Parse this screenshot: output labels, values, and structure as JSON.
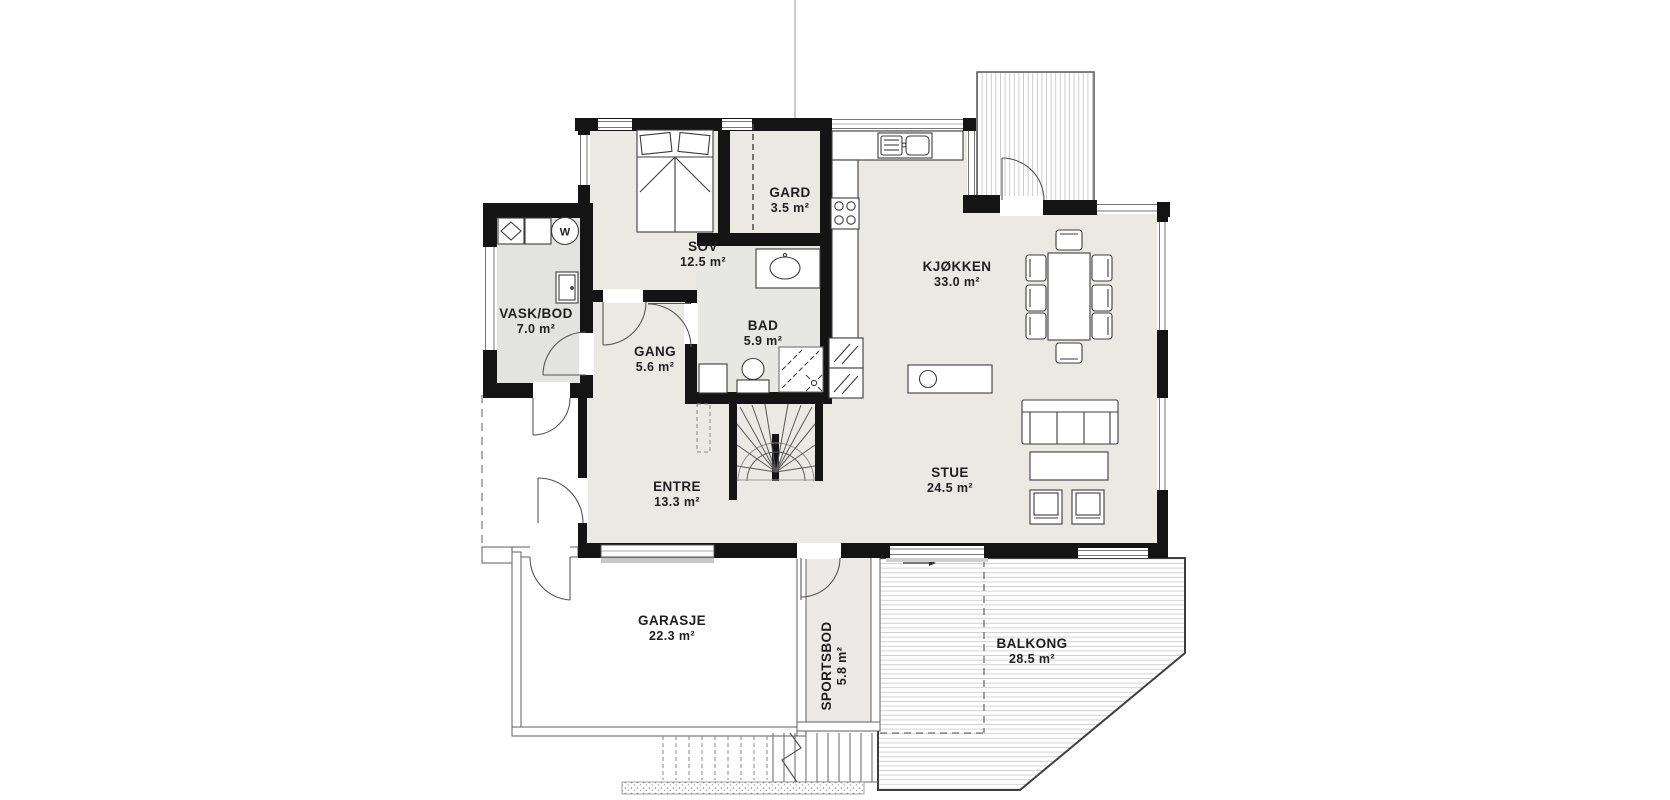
{
  "plan_title": "First floor plan",
  "rooms": [
    {
      "id": "sov",
      "name": "SOV",
      "area": "12.5 m²"
    },
    {
      "id": "gard",
      "name": "GARD",
      "area": "3.5 m²"
    },
    {
      "id": "kjokken",
      "name": "KJØKKEN",
      "area": "33.0 m²"
    },
    {
      "id": "vask_bod",
      "name": "VASK/BOD",
      "area": "7.0 m²"
    },
    {
      "id": "bad",
      "name": "BAD",
      "area": "5.9 m²"
    },
    {
      "id": "gang",
      "name": "GANG",
      "area": "5.6 m²"
    },
    {
      "id": "entre",
      "name": "ENTRE",
      "area": "13.3 m²"
    },
    {
      "id": "stue",
      "name": "STUE",
      "area": "24.5 m²"
    },
    {
      "id": "garasje",
      "name": "GARASJE",
      "area": "22.3 m²"
    },
    {
      "id": "sportsbod",
      "name": "SPORTSBOD",
      "area": "5.8 m²"
    },
    {
      "id": "balkong",
      "name": "BALKONG",
      "area": "28.5 m²"
    }
  ],
  "fixtures": {
    "washer_label": "W"
  },
  "colors": {
    "wall": "#141414",
    "floor_main": "#eae9e4",
    "floor_vask": "#e3e4e2",
    "floor_bad": "#e7e7e3",
    "floor_sportsbod": "#ebeae6",
    "deck_stripe": "#c9c9c9",
    "thin_wall": "#666666",
    "background": "#ffffff"
  }
}
